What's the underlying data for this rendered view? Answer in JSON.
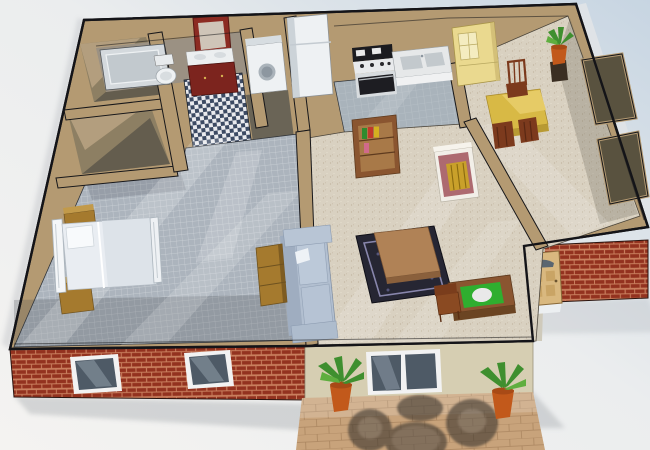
{
  "scene": {
    "title": "3D cutaway floor plan render of a one-bedroom apartment",
    "style": "isometric dollhouse view, no roof, afternoon sunlight streaks",
    "palette": {
      "bg_left": "#f4f3f1",
      "bg_right": "#c7d5e2",
      "wall_top": "#b49a72",
      "wall_dark": "#6e6654",
      "wall_edge": "#17171a",
      "floor_tile_gray": "#acb4bd",
      "floor_speckle": "#d9d1c1",
      "floor_kitchen": "#a9b3bb",
      "checker_dark": "#3c4a63",
      "checker_light": "#e9eaee",
      "brick": "#93321f",
      "mortar": "#c97f5e",
      "siding_beige": "#d6ceb2",
      "patio_paver": "#c8a37b",
      "glass": "#4e5a66",
      "window_frame": "#f2f2f2",
      "door_wood": "#d9b87f",
      "sofa": "#b2bfd0",
      "bed_white": "#e9edf2",
      "wood_gold": "#a57a2e",
      "wood_brown": "#8a5530",
      "table_yellow": "#d8b945",
      "hutch_yellow": "#ead98f",
      "fireplace_mauve": "#ad6a70",
      "fireplace_gold": "#c9a02a",
      "rug_dark": "#262633",
      "desk_green": "#2fae2f",
      "plant_green": "#3f8f2f",
      "pot_terracotta": "#c2591b",
      "appliance_white": "#eef1f3",
      "appliance_black": "#1b1b1f",
      "outdoor_furniture": "#3a352e"
    },
    "rooms": [
      {
        "id": "bathroom",
        "floor": "blue-white-checkerboard",
        "furniture": [
          "bathtub",
          "toilet",
          "vanity-sink",
          "framed-mirror"
        ]
      },
      {
        "id": "storage-room",
        "floor": "shadowed",
        "furniture": []
      },
      {
        "id": "walk-in-closet",
        "floor": "shadowed",
        "furniture": []
      },
      {
        "id": "bedroom",
        "floor": "gray-tile",
        "furniture": [
          "metal-frame-bed",
          "nightstand",
          "nightstand",
          "dresser"
        ]
      },
      {
        "id": "laundry-nook",
        "floor": "shadowed",
        "furniture": [
          "washer"
        ]
      },
      {
        "id": "kitchen",
        "floor": "gray-tile",
        "furniture": [
          "refrigerator",
          "stove-oven",
          "counter-with-double-sink"
        ]
      },
      {
        "id": "dining-area",
        "floor": "beige-speckle",
        "furniture": [
          "china-hutch",
          "dining-table",
          "dining-chair",
          "dining-chair",
          "dining-chair",
          "potted-plant-on-stand"
        ]
      },
      {
        "id": "living-room",
        "floor": "beige-speckle",
        "furniture": [
          "bookshelf",
          "fireplace",
          "sofa",
          "area-rug",
          "coffee-table",
          "desk",
          "desk-chair"
        ]
      },
      {
        "id": "entry-hall",
        "floor": "beige-speckle",
        "furniture": [
          "closet",
          "closet"
        ]
      }
    ],
    "exterior": {
      "walls": [
        "red-brick",
        "beige-siding"
      ],
      "features": [
        "front-door-with-fanlight",
        "bedroom-window",
        "bedroom-window",
        "sliding-window",
        "patio",
        "patio-round-table",
        "patio-chair",
        "patio-chair",
        "patio-chair",
        "potted-plant",
        "potted-plant"
      ]
    }
  }
}
